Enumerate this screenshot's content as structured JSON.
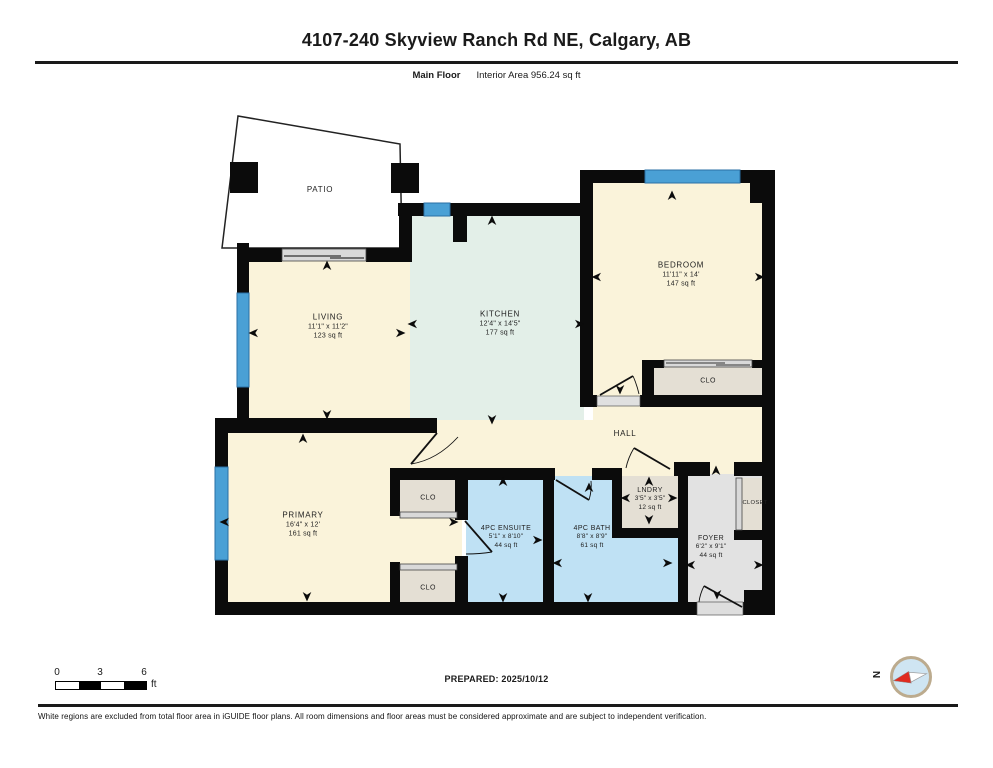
{
  "header": {
    "title": "4107-240 Skyview Ranch Rd NE, Calgary, AB",
    "floor_label": "Main Floor",
    "area_label": "Interior Area 956.24 sq ft"
  },
  "rooms": {
    "patio": {
      "name": "PATIO"
    },
    "living": {
      "name": "LIVING",
      "dims": "11'1\" x 11'2\"",
      "area": "123 sq ft"
    },
    "kitchen": {
      "name": "KITCHEN",
      "dims": "12'4\" x 14'5\"",
      "area": "177 sq ft"
    },
    "bedroom": {
      "name": "BEDROOM",
      "dims": "11'11\" x 14'",
      "area": "147 sq ft"
    },
    "bedroom_closet": {
      "name": "CLO"
    },
    "hall": {
      "name": "HALL"
    },
    "primary": {
      "name": "PRIMARY",
      "dims": "16'4\" x 12'",
      "area": "161 sq ft"
    },
    "primary_closet_1": {
      "name": "CLO"
    },
    "primary_closet_2": {
      "name": "CLO"
    },
    "ensuite": {
      "name": "4PC ENSUITE",
      "dims": "5'1\" x 8'10\"",
      "area": "44 sq ft"
    },
    "bath": {
      "name": "4PC BATH",
      "dims": "8'8\" x 8'9\"",
      "area": "61 sq ft"
    },
    "laundry": {
      "name": "LNDRY",
      "dims": "3'5\" x 3'5\"",
      "area": "12 sq ft"
    },
    "foyer_closet": {
      "name": "CLOSET"
    },
    "foyer": {
      "name": "FOYER",
      "dims": "6'2\" x 9'1\"",
      "area": "44 sq ft"
    }
  },
  "scale_bar": {
    "tick_0": "0",
    "tick_3": "3",
    "tick_6": "6",
    "unit": "ft"
  },
  "compass": {
    "north_label": "N"
  },
  "footer": {
    "prepared": "PREPARED: 2025/10/12",
    "disclaimer": "White regions are excluded from total floor area in iGUIDE floor plans. All room dimensions and floor areas must be considered approximate and are subject to independent verification."
  },
  "colors": {
    "wall": "#0b0b0b",
    "window_blue": "#4aa0d5",
    "room_cream": "#faf3da",
    "kitchen_mint": "#e3efe8",
    "bath_blue": "#bfe1f4",
    "closet_beige": "#e4dfd4",
    "foyer_gray": "#e2e2e2",
    "slider_gray": "#d9d9d9",
    "compass_needle_red": "#e02b20"
  }
}
